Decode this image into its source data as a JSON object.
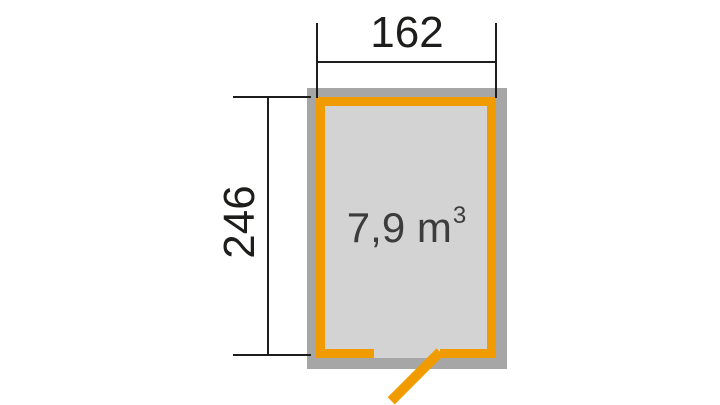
{
  "plan": {
    "dimensions": {
      "width_cm": "162",
      "height_cm": "246"
    },
    "volume": {
      "value": "7,9 m",
      "exponent": "3"
    },
    "colors": {
      "wall_gray": "#a6a6a6",
      "floor_gray": "#d3d3d3",
      "frame_orange": "#f09b00",
      "dimension_line_black": "#1d1d1b",
      "volume_text_gray": "#3c3c3c",
      "background_white": "#ffffff"
    }
  }
}
